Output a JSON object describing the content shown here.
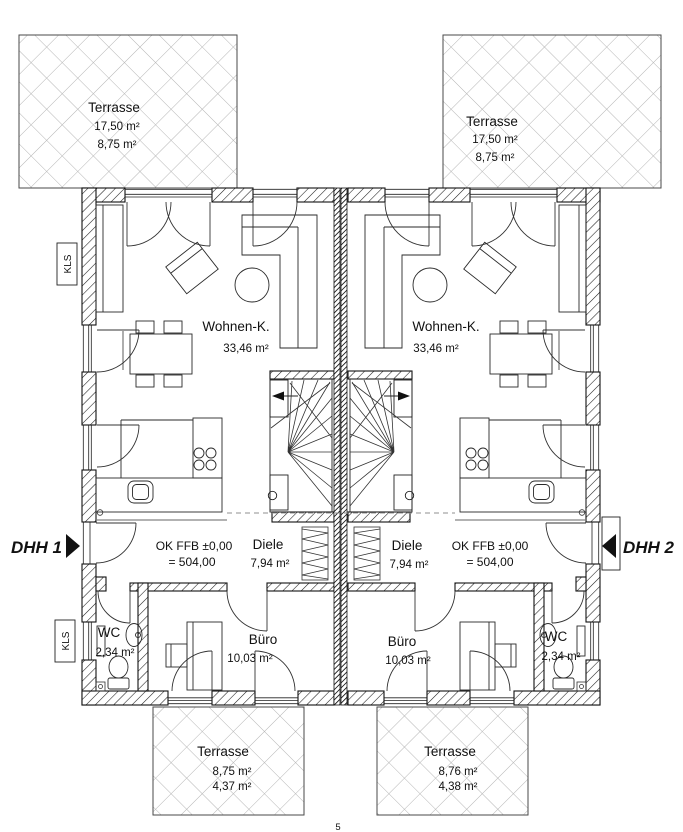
{
  "drawing": {
    "type": "floor-plan",
    "page_number": "5"
  },
  "markers": {
    "unit1": "DHH 1",
    "unit2": "DHH 2",
    "kls": "KLS"
  },
  "unit1": {
    "terrace_top": {
      "name": "Terrasse",
      "area1": "17,50 m²",
      "area2": "8,75 m²"
    },
    "living": {
      "name": "Wohnen-K.",
      "area": "33,46 m²"
    },
    "hall": {
      "name": "Diele",
      "area": "7,94 m²"
    },
    "level": {
      "line1": "OK FFB ±0,00",
      "line2": "= 504,00"
    },
    "office": {
      "name": "Büro",
      "area": "10,03 m²"
    },
    "wc": {
      "name": "WC",
      "area": "2,34 m²"
    },
    "terrace_bottom": {
      "name": "Terrasse",
      "area1": "8,75 m²",
      "area2": "4,37 m²"
    }
  },
  "unit2": {
    "terrace_top": {
      "name": "Terrasse",
      "area1": "17,50 m²",
      "area2": "8,75 m²"
    },
    "living": {
      "name": "Wohnen-K.",
      "area": "33,46 m²"
    },
    "hall": {
      "name": "Diele",
      "area": "7,94 m²"
    },
    "level": {
      "line1": "OK FFB ±0,00",
      "line2": "= 504,00"
    },
    "office": {
      "name": "Büro",
      "area": "10,03 m²"
    },
    "wc": {
      "name": "WC",
      "area": "2,34 m²"
    },
    "terrace_bottom": {
      "name": "Terrasse",
      "area1": "8,76 m²",
      "area2": "4,38 m²"
    }
  }
}
